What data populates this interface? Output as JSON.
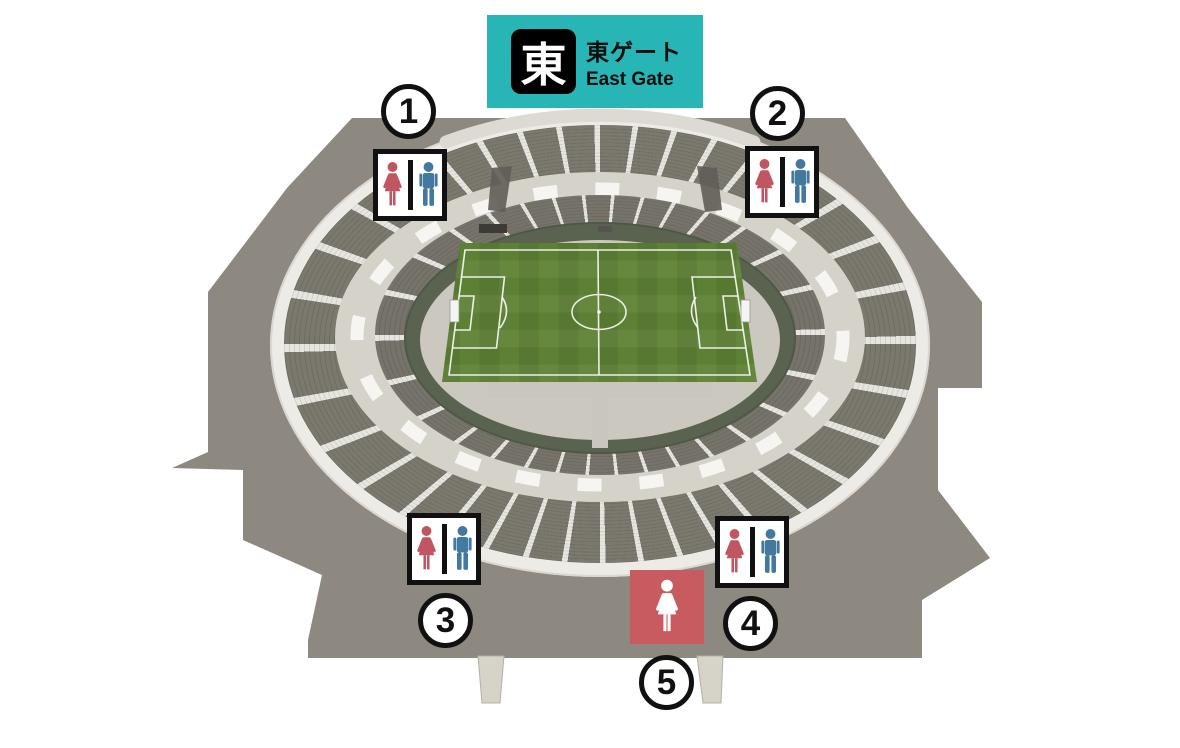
{
  "gate": {
    "kanji": "東",
    "label_ja": "東ゲート",
    "label_en": "East Gate"
  },
  "markers": [
    {
      "number": "1",
      "kind": "male-female-restroom"
    },
    {
      "number": "2",
      "kind": "male-female-restroom"
    },
    {
      "number": "3",
      "kind": "male-female-restroom"
    },
    {
      "number": "4",
      "kind": "male-female-restroom"
    },
    {
      "number": "5",
      "kind": "womens-only-restroom"
    }
  ],
  "colors": {
    "accent": "#27b5b5",
    "female": "#bf5662",
    "male": "#44799f",
    "womens_sign": "#c75b5f",
    "plaza": "#8d8980",
    "grass": "#5d8134"
  }
}
